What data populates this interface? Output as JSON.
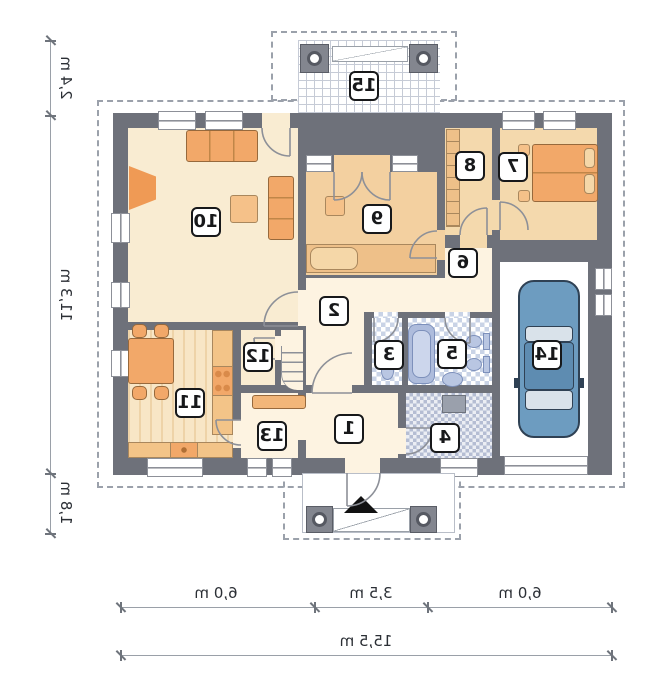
{
  "rooms": [
    {
      "number": "1"
    },
    {
      "number": "2"
    },
    {
      "number": "3"
    },
    {
      "number": "4"
    },
    {
      "number": "5"
    },
    {
      "number": "6"
    },
    {
      "number": "7"
    },
    {
      "number": "8"
    },
    {
      "number": "9"
    },
    {
      "number": "10"
    },
    {
      "number": "11"
    },
    {
      "number": "12"
    },
    {
      "number": "13"
    },
    {
      "number": "14"
    },
    {
      "number": "15"
    }
  ],
  "dimensions": {
    "left": [
      {
        "label": "2,4 m"
      },
      {
        "label": "11,3 m"
      },
      {
        "label": "1,8 m"
      }
    ],
    "bottom": [
      {
        "label": "6,0 m"
      },
      {
        "label": "3,5 m"
      },
      {
        "label": "6,0 m"
      }
    ],
    "total": "15,5 m"
  },
  "colors": {
    "wall": "#6e717a",
    "floor_cream": "#f9ecd2",
    "floor_hall": "#fdf3e1",
    "floor_wood": "#f3d0a0",
    "furniture_orange": "#f2a869",
    "tile_blue": "#c9d3e6",
    "car_blue": "#6d9cc0",
    "sanitary_blue": "#b9c6e2",
    "label_border": "#17181a",
    "dimension_gray": "#9aa0a8"
  }
}
